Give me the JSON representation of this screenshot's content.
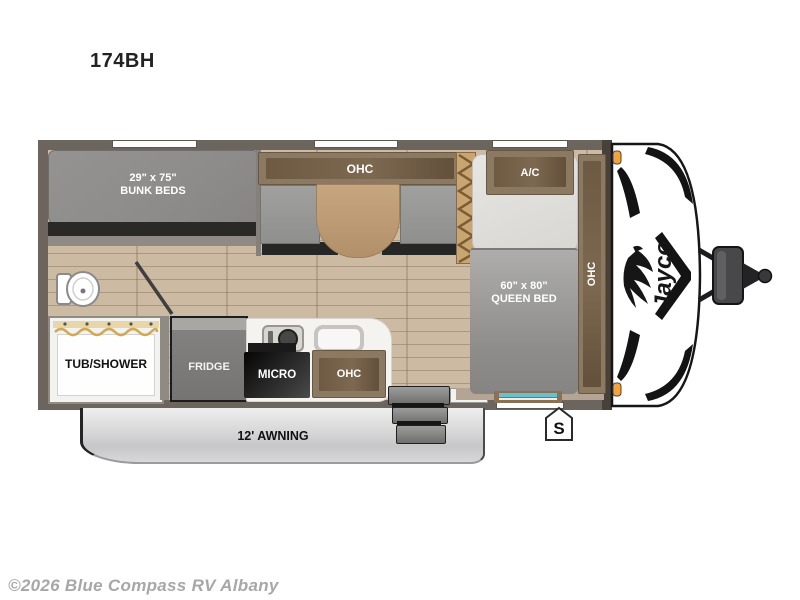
{
  "page": {
    "title": "174BH",
    "watermark": "©2026 Blue Compass RV Albany"
  },
  "floorplan": {
    "brand_logo": "Jayco",
    "labels": {
      "bunk_dims": "29\" x 75\"",
      "bunk_name": "BUNK BEDS",
      "dinette_ohc": "OHC",
      "ac": "A/C",
      "right_ohc": "OHC",
      "queen_dims": "60\" x 80\"",
      "queen_name": "QUEEN BED",
      "tub_shower": "TUB/SHOWER",
      "fridge": "FRIDGE",
      "micro": "MICRO",
      "kitchen_ohc": "OHC",
      "awning": "12' AWNING",
      "s_marker": "S"
    },
    "colors": {
      "wall": "#6b655d",
      "floor": "#cdbaa2",
      "cabinet": "#8b7962",
      "cabinet_inner": "#6e5a42",
      "mattress": "#8f8e8c",
      "awning": "#d9d9db",
      "marker_light": "#f2a33c",
      "window_glass": "#66c2cb"
    }
  }
}
